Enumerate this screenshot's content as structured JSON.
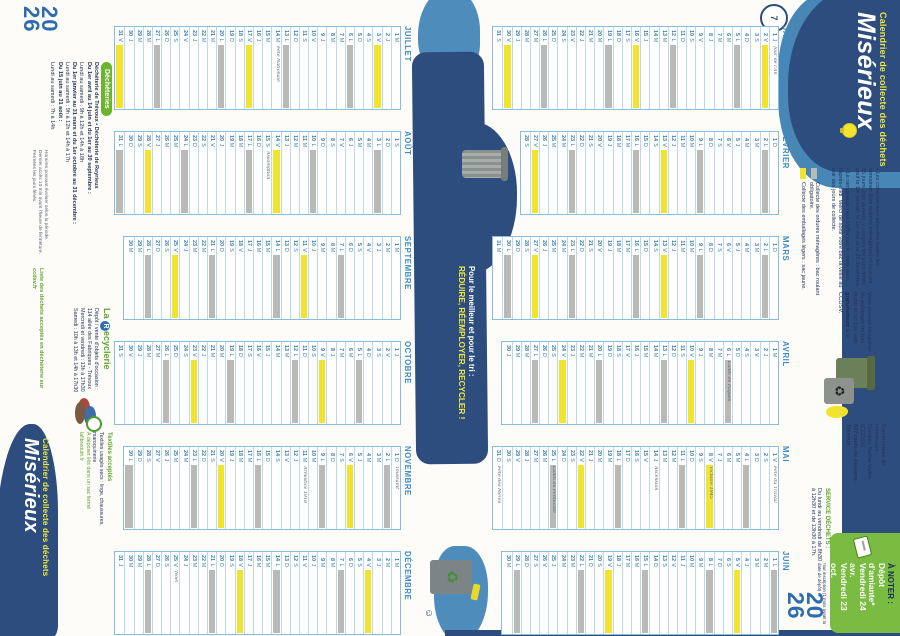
{
  "meta": {
    "year_top": "20",
    "year_bottom": "26"
  },
  "colors": {
    "navy": "#2d4d7e",
    "light_blue": "#4886b6",
    "accent_yellow": "#f1e63c",
    "cell_gray": "#b9bab6",
    "cell_yellow": "#f0e42f",
    "green": "#6cb32e",
    "note_green_box": "#79bc41",
    "year_blue": "#2e6cb0"
  },
  "header": {
    "kicker": "Calendrier de collecte des déchets",
    "title": "Misérieux",
    "clock_doodle": "7",
    "bullets": [
      "• Les collectes sont assurées toutes les semaines (bac ordures ménagères) et tous les 15 jours (bac jaunes), y compris les jours fériés sauf le 1er janvier, le 1er mai et le 25 décembre.",
      "• Le ramassage peut s'effectuer le matin et/ou l'après-midi. Merci de sortir votre bac la veille au soir des jours de collecte."
    ],
    "legend": [
      {
        "swatch": "gray",
        "label": "Collecte des ordures ménagères : bac roulant obligatoire."
      },
      {
        "swatch": "yellow",
        "label": "Collecte des emballages légers : sac jaune."
      }
    ],
    "swap_note": {
      "text1": "Vous pouvez récupérer ou échanger un bac jaune et un bac vert ",
      "bold": "gratuitement",
      "text2": " à la CCDSV."
    },
    "address": {
      "line1": "Communauté de communes",
      "line2": "Dombes Saône Vallée (CCDSV)",
      "line3": "627 route de Jassans - Trévoux"
    },
    "service": {
      "heading": "SERVICE DÉCHETS :",
      "line": "Du lundi au vendredi de 8h30 à 12h30 et de 13h30 à 17h."
    },
    "a_noter": {
      "heading": "À NOTER :",
      "line1": "Dépôt d'amiante*",
      "line2": "Vendredi 24 avr.",
      "line3": "Vendredi 23 oct.",
      "footnote": "*sur inscription (1 mois avant la date de dépôt)"
    }
  },
  "slogan": {
    "line1": "Pour le meilleur et pour le tri :",
    "line2": "RÉDUIRE, RÉEMPLOYER, RECYCLER !"
  },
  "calendar": {
    "weekday_letters": "LMMJVSD",
    "legend_note": "gris = ordures ménagères (lundi), jaune = emballages (vendredi, tous les 15 jours)",
    "months": [
      {
        "name": "JANVIER",
        "days": 31,
        "first": 3,
        "gray": [
          5,
          12,
          19,
          26
        ],
        "yellow": [
          2,
          16,
          30
        ],
        "notes": {
          "1": "Jour de l'An"
        }
      },
      {
        "name": "FÉVRIER",
        "days": 28,
        "first": 6,
        "gray": [
          2,
          9,
          16,
          23
        ],
        "yellow": [
          13,
          27
        ],
        "notes": {}
      },
      {
        "name": "MARS",
        "days": 31,
        "first": 6,
        "gray": [
          2,
          9,
          16,
          23,
          30
        ],
        "yellow": [
          13,
          27
        ],
        "notes": {}
      },
      {
        "name": "AVRIL",
        "days": 30,
        "first": 2,
        "gray": [
          6,
          13,
          20,
          27
        ],
        "yellow": [
          10,
          24
        ],
        "notes": {
          "6": "Lundi de Pâques"
        }
      },
      {
        "name": "MAI",
        "days": 31,
        "first": 4,
        "gray": [
          4,
          11,
          18,
          25
        ],
        "yellow": [
          8,
          22
        ],
        "notes": {
          "1": "Fête du Travail",
          "8": "Victoire 1945",
          "14": "Ascension",
          "25": "Lundi de Pentecôte",
          "31": "Fête des Mères"
        }
      },
      {
        "name": "JUIN",
        "days": 30,
        "first": 0,
        "gray": [
          1,
          8,
          15,
          22,
          29
        ],
        "yellow": [
          5,
          19
        ],
        "notes": {}
      },
      {
        "name": "JUILLET",
        "days": 31,
        "first": 2,
        "gray": [
          6,
          13,
          20,
          27
        ],
        "yellow": [
          3,
          17,
          31
        ],
        "notes": {
          "14": "Fête Nationale"
        }
      },
      {
        "name": "AOÛT",
        "days": 31,
        "first": 5,
        "gray": [
          3,
          10,
          17,
          24,
          31
        ],
        "yellow": [
          14,
          28
        ],
        "notes": {
          "15": "Assomption"
        }
      },
      {
        "name": "SEPTEMBRE",
        "days": 30,
        "first": 1,
        "gray": [
          7,
          14,
          21,
          28
        ],
        "yellow": [
          11,
          25
        ],
        "notes": {}
      },
      {
        "name": "OCTOBRE",
        "days": 31,
        "first": 3,
        "gray": [
          5,
          12,
          19,
          26
        ],
        "yellow": [
          9,
          23
        ],
        "notes": {}
      },
      {
        "name": "NOVEMBRE",
        "days": 30,
        "first": 6,
        "gray": [
          2,
          9,
          16,
          23,
          30
        ],
        "yellow": [
          6,
          20
        ],
        "notes": {
          "1": "Toussaint",
          "11": "Armistice 1918"
        }
      },
      {
        "name": "DÉCEMBRE",
        "days": 31,
        "first": 1,
        "gray": [
          7,
          14,
          21,
          28
        ],
        "yellow": [
          4,
          18
        ],
        "notes": {
          "25": "Noël"
        }
      }
    ]
  },
  "footer": {
    "dechetteries": {
      "pill": "Déchèteries",
      "sites": "Déchèterie de Trévoux • Déchèterie de Reyrieux",
      "lines": [
        "Du 1er avril au 14 juin et du 1er au 30 septembre :",
        "Lundi au samedi : 9h à 12h et 14h à 18h",
        "Du 1er janvier au 31 mars et du 1er octobre au 31 décembre :",
        "Lundi au samedi : 9h à 12h et 14h à 17h",
        "Du 15 juin au 31 août :",
        "Lundi au samedi : 7h à 14h"
      ],
      "note1": "Horaires pouvant évoluer selon la période.",
      "note2": "Dernier accès 10 min avant l'heure de fermeture.",
      "note3": "Fermées les jours fériés.",
      "green": "Liste des déchets acceptés en déchèterie sur ccdsv.fr"
    },
    "recyclerie": {
      "logo_la": "La ",
      "logo_r": "R",
      "logo_rest": "ecyclerie",
      "line1": "Dépôt / vente d'objets d'occasion :",
      "line2": "114 allée des Fabriques - Trévoux",
      "line3": "Mercredi et vendredi : 13h à 17h30",
      "line4": "Samedi : 10h à 13h et 14h à 17h30"
    },
    "textiles": {
      "heading": "Textiles acceptés",
      "line": "Textiles usagés secs : linge, chaussures, maroquinerie",
      "green1": "À déposer liés dans un sac fermé",
      "green2": "lafibredutri.fr"
    },
    "kicker": "Calendrier de collecte des déchets",
    "title": "Misérieux"
  }
}
